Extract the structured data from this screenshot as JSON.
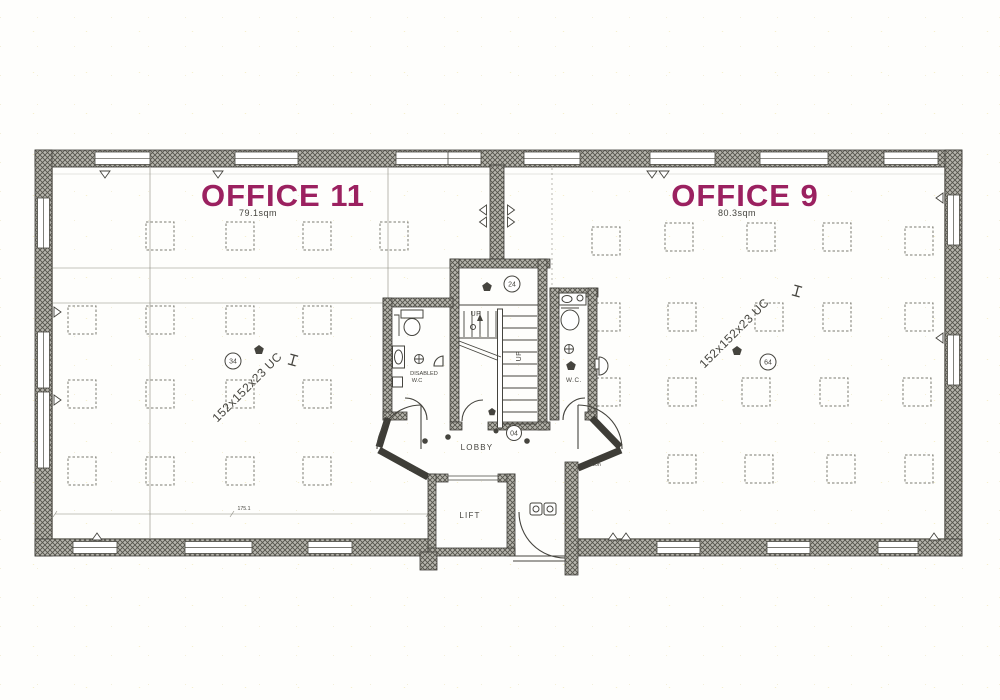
{
  "colors": {
    "label": "#9b2160",
    "ink": "#45443e"
  },
  "office11": {
    "label": "OFFICE 11",
    "area": "79.1sqm",
    "beam": "152x152x23 UC",
    "ref": "34"
  },
  "office9": {
    "label": "OFFICE 9",
    "area": "80.3sqm",
    "beam": "152x152x23 UC",
    "ref": "64"
  },
  "core": {
    "lobby": "LOBBY",
    "lobby_ref": "04",
    "lift": "LIFT",
    "stair_up_a": "UP",
    "stair_up_b": "UP",
    "stair_ref": "24",
    "disabled_wc_line1": "DISABLED",
    "disabled_wc_line2": "W.C",
    "wc": "W.C."
  },
  "dims": {
    "left_door_head": "400h",
    "right_door_head": "400h",
    "bottom": "175.1"
  },
  "plan": {
    "grid_size": 28,
    "grid_squares": {
      "office11": [
        [
          146,
          222
        ],
        [
          226,
          222
        ],
        [
          303,
          222
        ],
        [
          380,
          222
        ],
        [
          68,
          306
        ],
        [
          146,
          306
        ],
        [
          226,
          306
        ],
        [
          303,
          306
        ],
        [
          68,
          380
        ],
        [
          146,
          380
        ],
        [
          226,
          380
        ],
        [
          303,
          380
        ],
        [
          68,
          457
        ],
        [
          146,
          457
        ],
        [
          226,
          457
        ],
        [
          303,
          457
        ]
      ],
      "office9": [
        [
          592,
          227
        ],
        [
          665,
          223
        ],
        [
          747,
          223
        ],
        [
          823,
          223
        ],
        [
          905,
          227
        ],
        [
          592,
          303
        ],
        [
          668,
          303
        ],
        [
          755,
          303
        ],
        [
          823,
          303
        ],
        [
          905,
          303
        ],
        [
          592,
          378
        ],
        [
          668,
          378
        ],
        [
          742,
          378
        ],
        [
          820,
          378
        ],
        [
          903,
          378
        ],
        [
          668,
          455
        ],
        [
          745,
          455
        ],
        [
          827,
          455
        ],
        [
          905,
          455
        ]
      ]
    },
    "windows": {
      "top": [
        [
          95,
          150
        ],
        [
          235,
          298
        ],
        [
          396,
          450
        ],
        [
          448,
          481
        ],
        [
          524,
          580
        ],
        [
          650,
          715
        ],
        [
          760,
          828
        ],
        [
          884,
          938
        ]
      ],
      "bottom_left": [
        [
          73,
          117
        ],
        [
          185,
          252
        ],
        [
          308,
          352
        ]
      ],
      "bottom_right": [
        [
          657,
          700
        ],
        [
          767,
          810
        ],
        [
          878,
          918
        ]
      ],
      "left": [
        [
          198,
          248
        ],
        [
          332,
          388
        ],
        [
          392,
          468
        ]
      ],
      "right": [
        [
          195,
          245
        ],
        [
          335,
          385
        ]
      ]
    },
    "radiators": {
      "top": [
        105,
        218,
        652,
        664
      ],
      "bottom": [
        97,
        613,
        626,
        934
      ],
      "left": [
        312,
        400
      ],
      "right": [
        198,
        338
      ],
      "divider": [
        210,
        222
      ]
    }
  }
}
